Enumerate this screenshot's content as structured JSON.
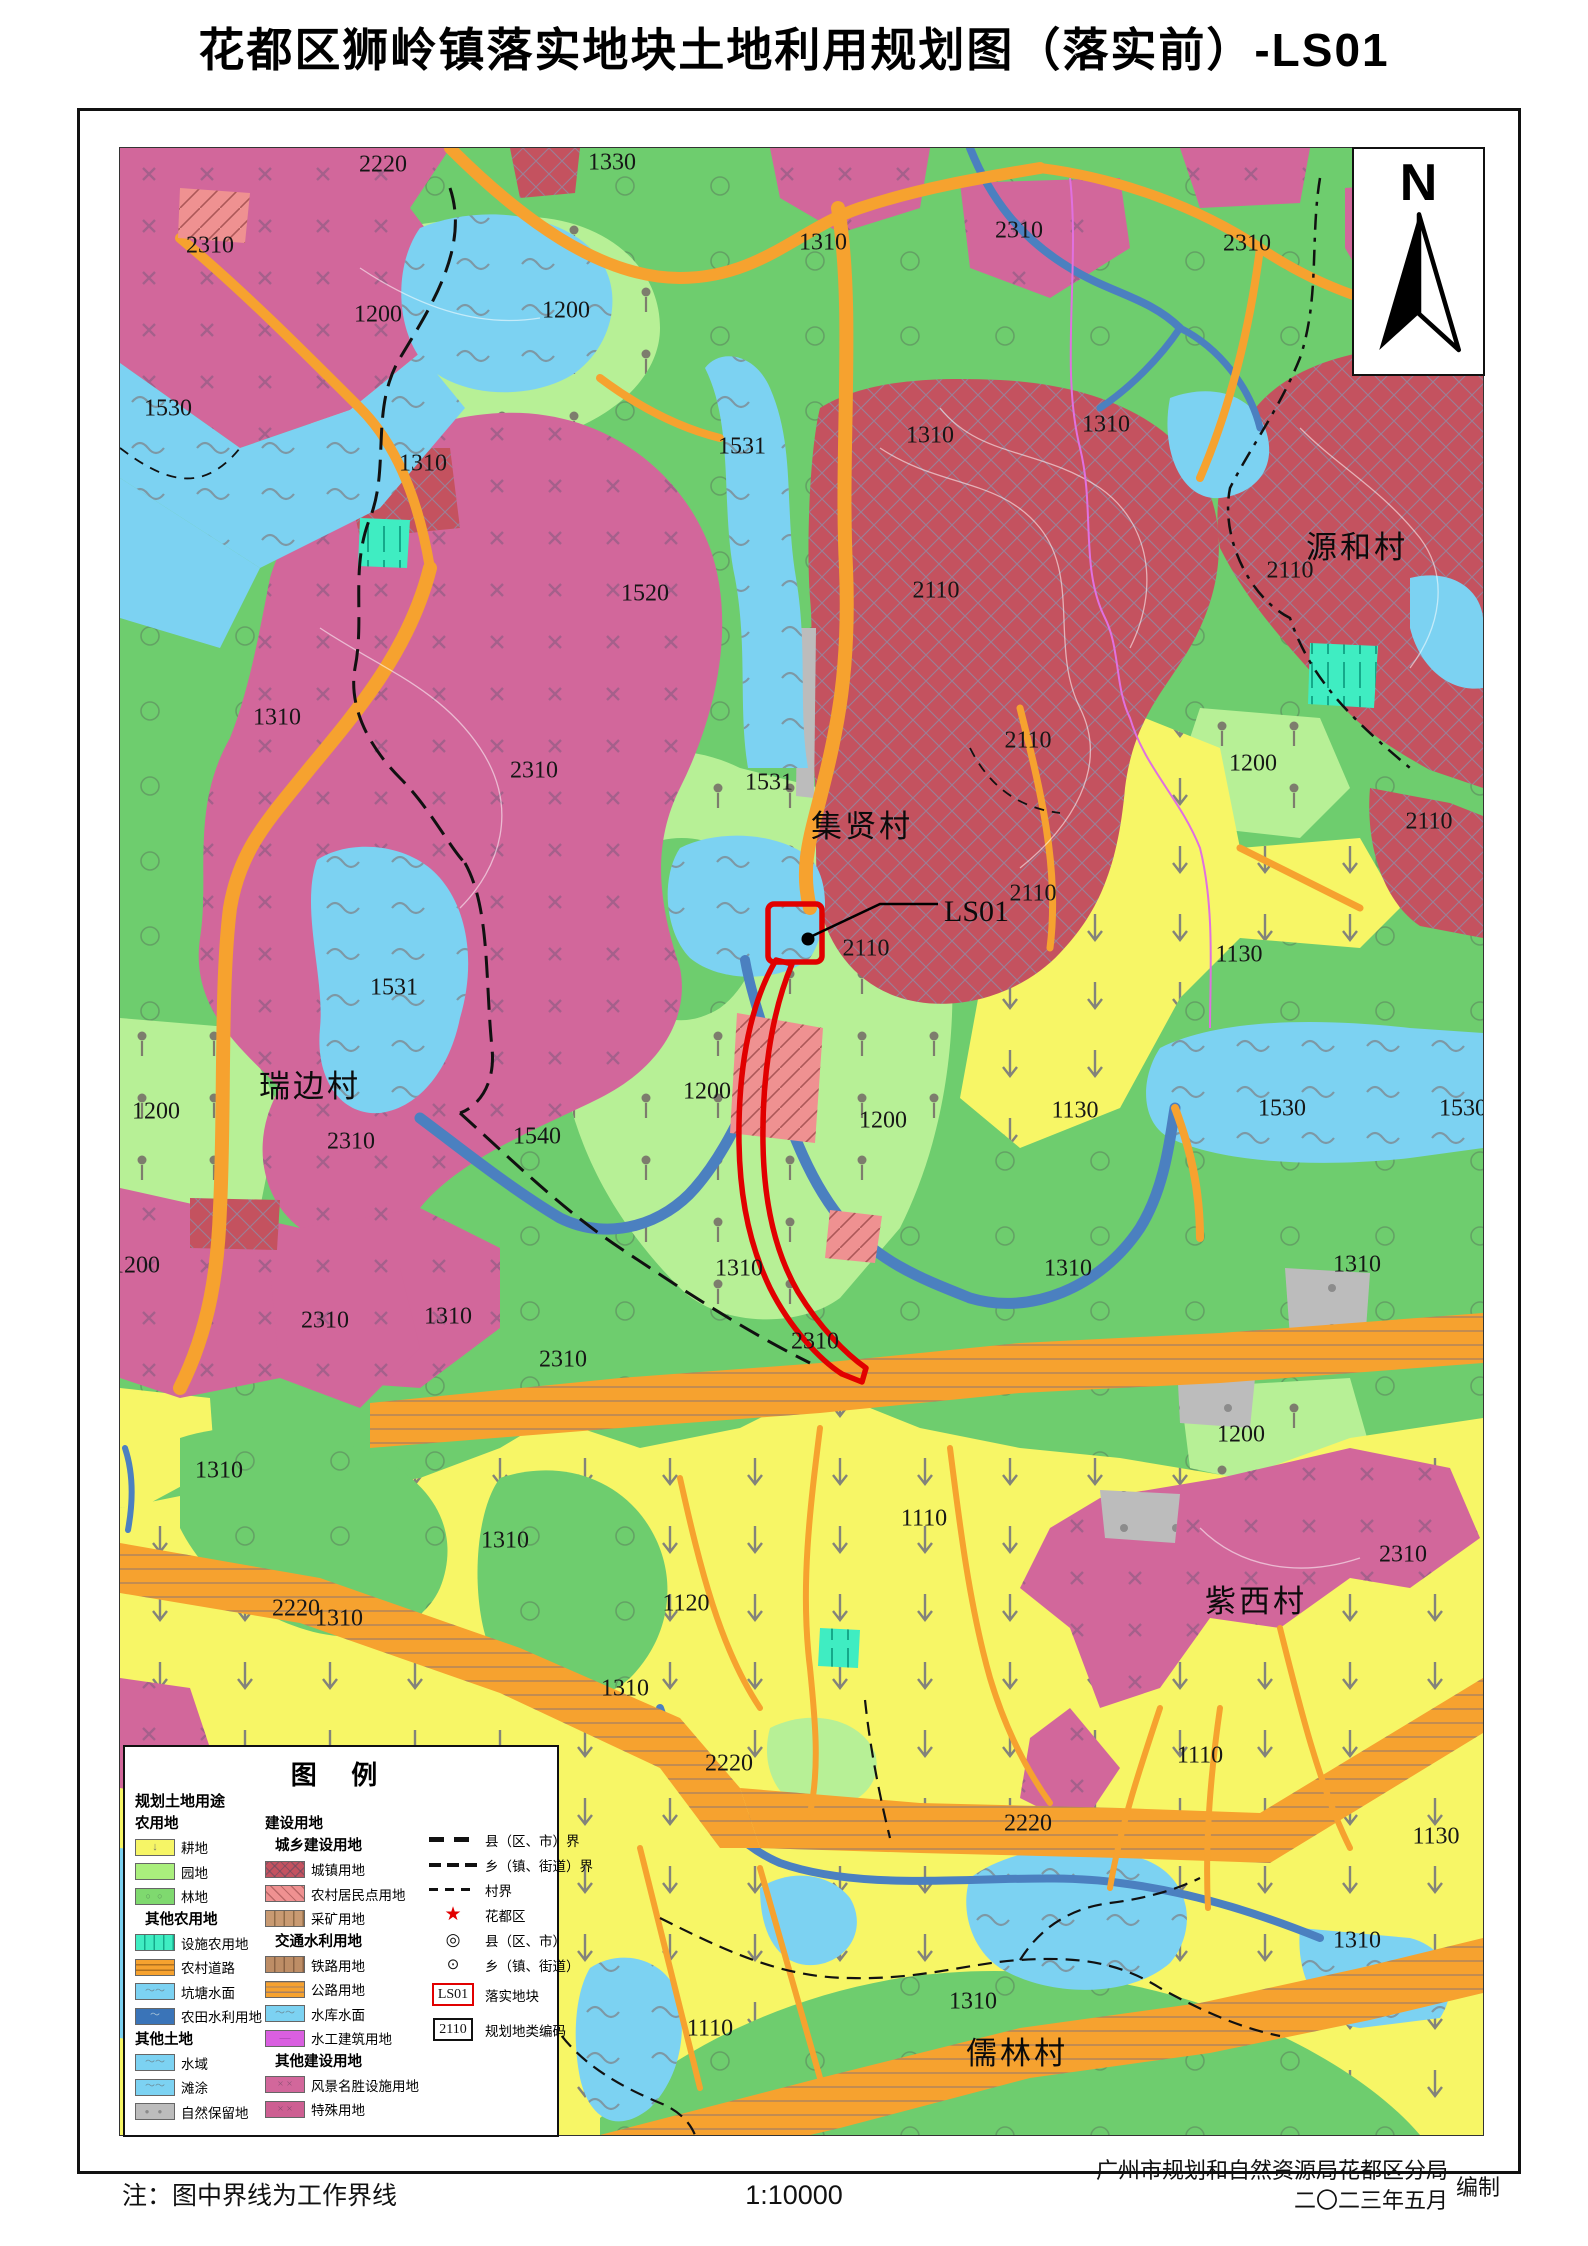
{
  "title": "花都区狮岭镇落实地块土地利用规划图（落实前）-LS01",
  "north_label": "N",
  "footer": {
    "note": "注：图中界线为工作界线",
    "scale": "1:10000",
    "attribution_line1": "广州市规划和自然资源局花都区分局",
    "attribution_line2": "二〇二三年五月",
    "attribution_suffix": "编制"
  },
  "colors": {
    "parcel_red": "#e10000",
    "scenic_magenta": "#d2679b",
    "urban_red": "#c4525f",
    "forest_green": "#6ecd6e",
    "orchard_green": "#b7f096",
    "cropland_yellow": "#f7f666",
    "water_blue": "#7cd2f2",
    "river_blue": "#4b80c0",
    "road_orange": "#f6a22f",
    "facility_cyan": "#3fedc2",
    "nature_gray": "#bcbcbc",
    "residential_pink": "#ef9191",
    "hydraulic_purple": "#d95fe0"
  },
  "legend": {
    "title": "图 例",
    "header": "规划土地用途",
    "col1": [
      {
        "k": "h1",
        "label": "农用地"
      },
      {
        "k": "item",
        "swatch": "crop",
        "label": "耕地"
      },
      {
        "k": "item",
        "swatch": "orchard",
        "label": "园地"
      },
      {
        "k": "item",
        "swatch": "forest",
        "label": "林地"
      },
      {
        "k": "h2",
        "label": "其他农用地"
      },
      {
        "k": "item",
        "swatch": "facility",
        "label": "设施农用地"
      },
      {
        "k": "item",
        "swatch": "rural-road",
        "label": "农村道路"
      },
      {
        "k": "item",
        "swatch": "pond",
        "label": "坑塘水面"
      },
      {
        "k": "item",
        "swatch": "irrigation",
        "label": "农田水利用地"
      },
      {
        "k": "h1",
        "label": "其他土地"
      },
      {
        "k": "item",
        "swatch": "water",
        "label": "水域"
      },
      {
        "k": "item",
        "swatch": "flats",
        "label": "滩涂"
      },
      {
        "k": "item",
        "swatch": "nature",
        "label": "自然保留地"
      }
    ],
    "col2": [
      {
        "k": "h1",
        "label": "建设用地"
      },
      {
        "k": "h2",
        "label": "城乡建设用地"
      },
      {
        "k": "item",
        "swatch": "urban",
        "label": "城镇用地"
      },
      {
        "k": "item",
        "swatch": "village-res",
        "label": "农村居民点用地"
      },
      {
        "k": "item",
        "swatch": "mining",
        "label": "采矿用地"
      },
      {
        "k": "h2",
        "label": "交通水利用地"
      },
      {
        "k": "item",
        "swatch": "railway",
        "label": "铁路用地"
      },
      {
        "k": "item",
        "swatch": "highway",
        "label": "公路用地"
      },
      {
        "k": "item",
        "swatch": "reservoir",
        "label": "水库水面"
      },
      {
        "k": "item",
        "swatch": "hydraulic",
        "label": "水工建筑用地"
      },
      {
        "k": "h2",
        "label": "其他建设用地"
      },
      {
        "k": "item",
        "swatch": "scenic",
        "label": "风景名胜设施用地"
      },
      {
        "k": "item",
        "swatch": "special",
        "label": "特殊用地"
      }
    ],
    "col3": [
      {
        "sym": "county-line",
        "label": "县（区、市）界"
      },
      {
        "sym": "town-line",
        "label": "乡（镇、街道）界"
      },
      {
        "sym": "village-line",
        "label": "村界"
      },
      {
        "sym": "star",
        "label": "花都区"
      },
      {
        "sym": "county-pt",
        "label": "县（区、市）",
        "glyph": "◎"
      },
      {
        "sym": "town-pt",
        "label": "乡（镇、街道）",
        "glyph": "⊙"
      },
      {
        "sym": "ls01-box",
        "label": "落实地块",
        "box": "LS01"
      },
      {
        "sym": "code-box",
        "label": "规划地类编码",
        "box": "2110"
      }
    ],
    "star_glyph": "★"
  },
  "map": {
    "ls01_label": "LS01",
    "villages": [
      {
        "t": "源和村",
        "x": 1237,
        "y": 403
      },
      {
        "t": "集贤村",
        "x": 742,
        "y": 682
      },
      {
        "t": "瑞边村",
        "x": 190,
        "y": 942
      },
      {
        "t": "紫西村",
        "x": 1136,
        "y": 1457
      },
      {
        "t": "儒林村",
        "x": 897,
        "y": 1909
      }
    ],
    "labels": [
      {
        "t": "2220",
        "x": 263,
        "y": 18
      },
      {
        "t": "1330",
        "x": 492,
        "y": 16
      },
      {
        "t": "2310",
        "x": 90,
        "y": 99
      },
      {
        "t": "1310",
        "x": 703,
        "y": 96
      },
      {
        "t": "2310",
        "x": 899,
        "y": 84
      },
      {
        "t": "2310",
        "x": 1127,
        "y": 97
      },
      {
        "t": "1200",
        "x": 258,
        "y": 168
      },
      {
        "t": "1200",
        "x": 446,
        "y": 164
      },
      {
        "t": "1530",
        "x": 48,
        "y": 262
      },
      {
        "t": "1310",
        "x": 303,
        "y": 317
      },
      {
        "t": "1531",
        "x": 622,
        "y": 300
      },
      {
        "t": "1310",
        "x": 810,
        "y": 289
      },
      {
        "t": "1310",
        "x": 986,
        "y": 278
      },
      {
        "t": "2110",
        "x": 1170,
        "y": 424
      },
      {
        "t": "1520",
        "x": 525,
        "y": 447
      },
      {
        "t": "2110",
        "x": 816,
        "y": 444
      },
      {
        "t": "2310",
        "x": 414,
        "y": 624
      },
      {
        "t": "1531",
        "x": 649,
        "y": 636
      },
      {
        "t": "2110",
        "x": 908,
        "y": 594
      },
      {
        "t": "2110",
        "x": 1309,
        "y": 675
      },
      {
        "t": "1310",
        "x": 157,
        "y": 571
      },
      {
        "t": "1200",
        "x": 1133,
        "y": 617
      },
      {
        "t": "2110",
        "x": 746,
        "y": 802
      },
      {
        "t": "2110",
        "x": 913,
        "y": 747
      },
      {
        "t": "1130",
        "x": 1119,
        "y": 808
      },
      {
        "t": "1531",
        "x": 274,
        "y": 841
      },
      {
        "t": "1200",
        "x": 36,
        "y": 965
      },
      {
        "t": "2310",
        "x": 231,
        "y": 995
      },
      {
        "t": "1540",
        "x": 417,
        "y": 990
      },
      {
        "t": "1200",
        "x": 587,
        "y": 945
      },
      {
        "t": "1200",
        "x": 763,
        "y": 974
      },
      {
        "t": "1130",
        "x": 955,
        "y": 964
      },
      {
        "t": "1530",
        "x": 1162,
        "y": 962
      },
      {
        "t": "1530",
        "x": 1343,
        "y": 962
      },
      {
        "t": "1200",
        "x": 16,
        "y": 1119
      },
      {
        "t": "1310",
        "x": 328,
        "y": 1170
      },
      {
        "t": "2310",
        "x": 205,
        "y": 1174
      },
      {
        "t": "1310",
        "x": 619,
        "y": 1122
      },
      {
        "t": "1310",
        "x": 948,
        "y": 1122
      },
      {
        "t": "1310",
        "x": 1237,
        "y": 1118
      },
      {
        "t": "2310",
        "x": 443,
        "y": 1213
      },
      {
        "t": "2310",
        "x": 695,
        "y": 1195
      },
      {
        "t": "1200",
        "x": 1121,
        "y": 1288
      },
      {
        "t": "1310",
        "x": 99,
        "y": 1324
      },
      {
        "t": "1310",
        "x": 385,
        "y": 1394
      },
      {
        "t": "2310",
        "x": 1283,
        "y": 1408
      },
      {
        "t": "2220",
        "x": 176,
        "y": 1462
      },
      {
        "t": "1120",
        "x": 566,
        "y": 1457
      },
      {
        "t": "1110",
        "x": 804,
        "y": 1372
      },
      {
        "t": "1110",
        "x": 1080,
        "y": 1609
      },
      {
        "t": "2220",
        "x": 609,
        "y": 1617
      },
      {
        "t": "2220",
        "x": 908,
        "y": 1677
      },
      {
        "t": "1130",
        "x": 1316,
        "y": 1690
      },
      {
        "t": "1110",
        "x": 590,
        "y": 1882
      },
      {
        "t": "1310",
        "x": 853,
        "y": 1855
      },
      {
        "t": "1310",
        "x": 1237,
        "y": 1794
      },
      {
        "t": "1310",
        "x": 505,
        "y": 1542
      },
      {
        "t": "1310",
        "x": 219,
        "y": 1472
      }
    ]
  }
}
